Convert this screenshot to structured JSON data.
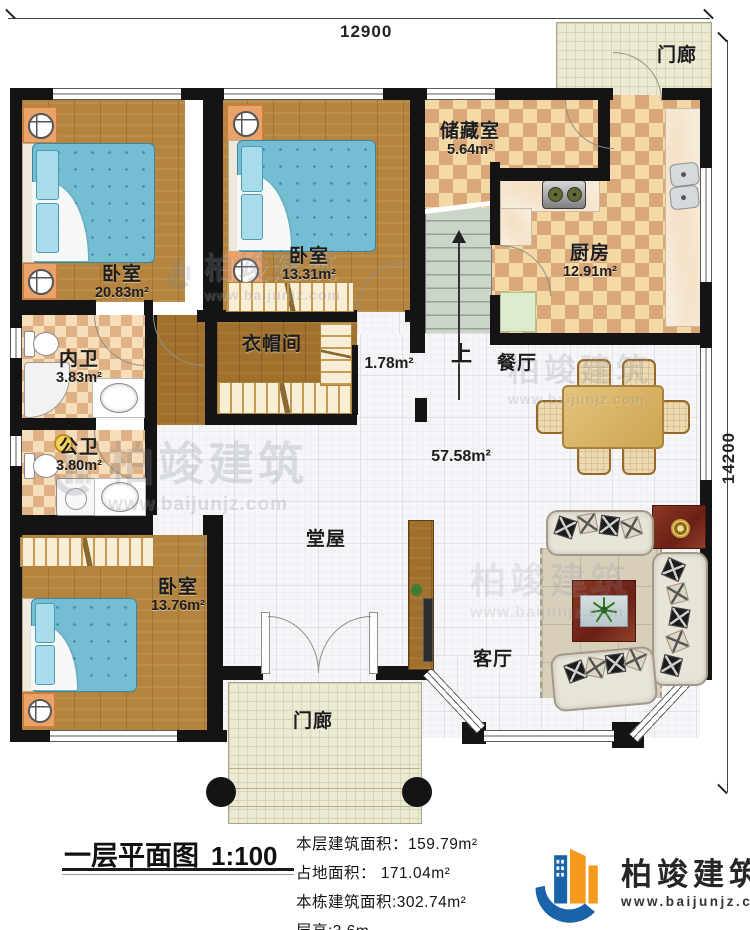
{
  "dimensions": {
    "width": "12900",
    "height": "14200"
  },
  "rooms": {
    "porch_top": {
      "label": "门廊"
    },
    "bedroom_master": {
      "label": "卧室",
      "area": "20.83m²"
    },
    "bedroom_second": {
      "label": "卧室",
      "area": "13.31m²"
    },
    "storage": {
      "label": "储藏室",
      "area": "5.64m²"
    },
    "kitchen": {
      "label": "厨房",
      "area": "12.91m²"
    },
    "stairs": {
      "label": "上"
    },
    "hallway": {
      "area": "1.78m²"
    },
    "dining": {
      "label": "餐厅"
    },
    "cloakroom": {
      "label": "衣帽间"
    },
    "ensuite_bath": {
      "label": "内卫",
      "area": "3.83m²"
    },
    "shared_bath": {
      "label": "公卫",
      "area": "3.80m²"
    },
    "main_hall": {
      "label": "堂屋",
      "area": "57.58m²"
    },
    "bedroom_third": {
      "label": "卧室",
      "area": "13.76m²"
    },
    "living": {
      "label": "客厅"
    },
    "porch_bottom": {
      "label": "门廊"
    }
  },
  "title_block": {
    "title": "一层平面图",
    "scale": "1:100",
    "stats": [
      "本层建筑面积：159.79m²",
      "占地面积： 171.04m²",
      "本栋建筑面积:302.74m²",
      "层高:3.6m"
    ]
  },
  "branding": {
    "name": "柏竣建筑",
    "website": "www.baijunjz.com"
  },
  "watermark": {
    "text": "柏竣建筑",
    "url": "www.baijunjz.com"
  },
  "colors": {
    "wall": "#141414",
    "wood": "#b5853f",
    "bed": "#74bdd3",
    "brand_blue": "#1a63a8",
    "brand_orange": "#f59a1d",
    "dark_wood": "#7c2f22"
  }
}
